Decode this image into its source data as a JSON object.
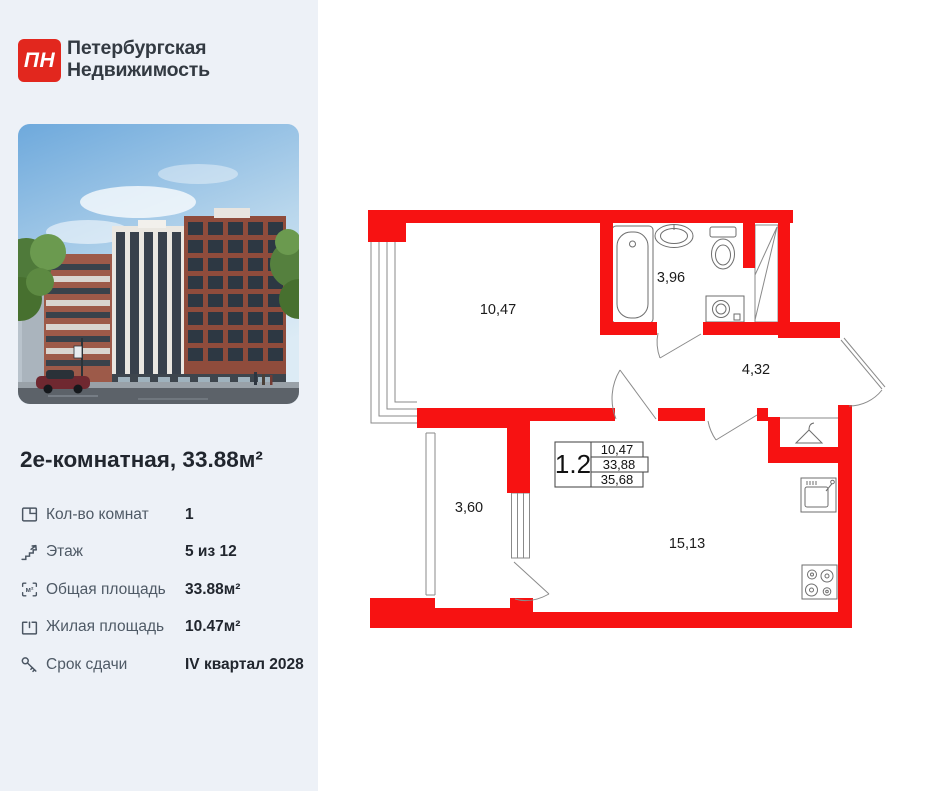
{
  "brand": {
    "logo_text": "ПН",
    "name_line1": "Петербургская",
    "name_line2": "Недвижимость"
  },
  "listing": {
    "title": "2е-комнатная, 33.88м²",
    "details": [
      {
        "icon": "rooms-icon",
        "label": "Кол-во комнат",
        "value": "1"
      },
      {
        "icon": "floor-icon",
        "label": "Этаж",
        "value": "5 из 12"
      },
      {
        "icon": "total-area-icon",
        "label": "Общая площадь",
        "value": "33.88м²"
      },
      {
        "icon": "living-area-icon",
        "label": "Жилая площадь",
        "value": "10.47м²"
      },
      {
        "icon": "deadline-icon",
        "label": "Срок сдачи",
        "value": "IV квартал 2028"
      }
    ],
    "area_icon_text": "м²"
  },
  "floor_plan": {
    "rooms": {
      "room": "10,47",
      "bathroom": "3,96",
      "hallway": "4,32",
      "balcony": "3,60",
      "kitchen": "15,13"
    },
    "legend": {
      "unit": "1.2",
      "row1": "10,47",
      "row2": "33,88",
      "row3": "35,68"
    }
  },
  "colors": {
    "panel_bg": "#edf1f7",
    "logo_red": "#e2271e",
    "plan_wall_red": "#f71212",
    "text_dark": "#21262e",
    "text_gray": "#4f5a66"
  }
}
